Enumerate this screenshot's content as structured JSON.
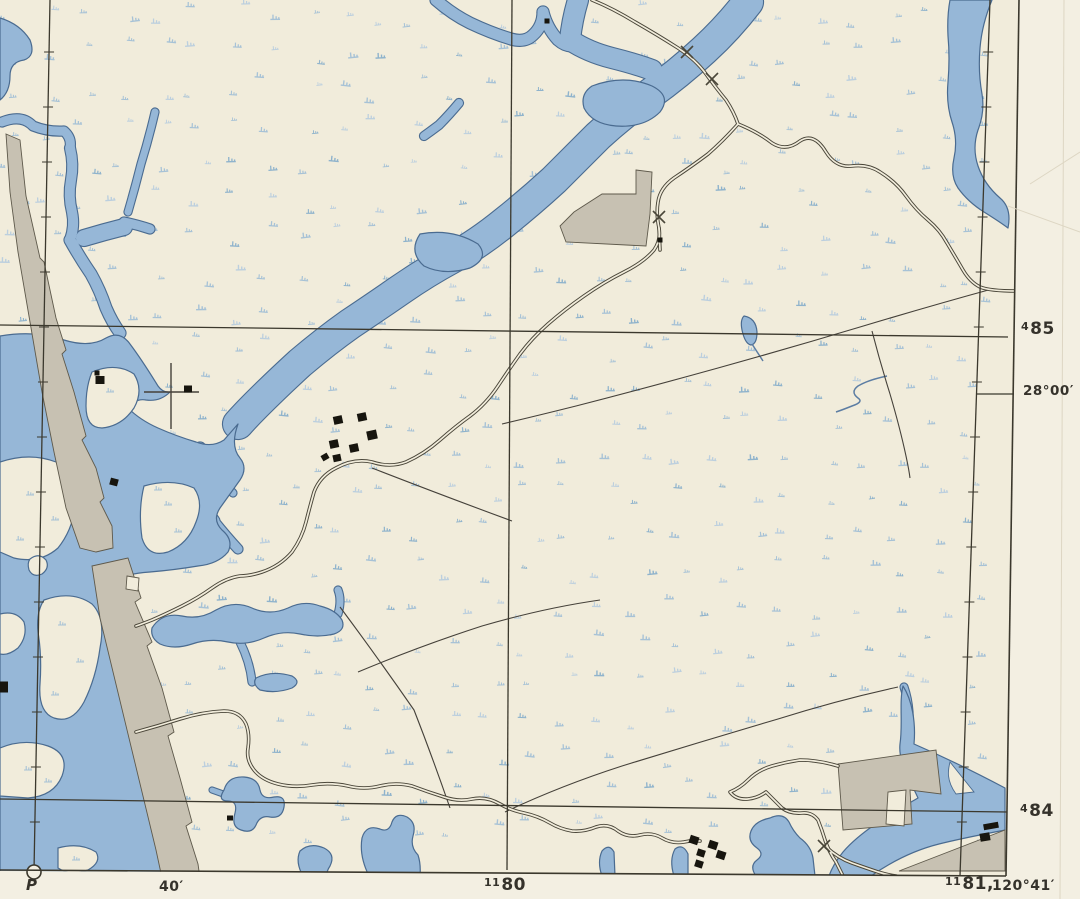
{
  "page": {
    "title": "Scanned topographic map sheet, coastal marsh with tidal creeks"
  },
  "colors": {
    "paper": "#f1ecdb",
    "margin": "#f3efe2",
    "water": "#96b7d7",
    "water_line": "#4a6b90",
    "stream": "#5c7da3",
    "tuft": "#a7c2d6",
    "tuft_light": "#bccfde",
    "tuft_dark": "#8fb3cc",
    "gray_fill": "#c7c1b2",
    "gray_line": "#5e594b",
    "road": "#4a4639",
    "thin": "#45413a",
    "grid": "#3b382d",
    "building": "#17150e",
    "crease": "#ddd6c3",
    "text": "#35322b"
  },
  "margin_labels": {
    "grid_485": {
      "sup": "4",
      "main": "85"
    },
    "lat_2800": "28°00′",
    "grid_484": {
      "sup": "4",
      "main": "84"
    },
    "p_mark": "P",
    "min_40": "40′",
    "grid_1180": {
      "sup": "11",
      "main": "80"
    },
    "grid_1181": {
      "sup": "11",
      "main": "81,"
    },
    "lon_12041": "120°41′"
  },
  "map": {
    "tufts": {
      "seed": 1973,
      "step": 37,
      "jitter": 13
    },
    "water": {
      "creeks": [
        {
          "d": "M 2 122 Q 22 114 33 126 Q 48 132 64 131 Q 72 138 70 148",
          "w": 9
        },
        {
          "d": "M 70 148 Q 74 164 71 180 Q 68 196 72 212 Q 75 226 70 240",
          "w": 10
        },
        {
          "d": "M 70 240 Q 80 258 91 274 Q 100 290 106 308 Q 112 322 120 333",
          "w": 11
        },
        {
          "d": "M 155 112 Q 149 138 141 164 Q 135 188 128 212",
          "w": 7
        },
        {
          "d": "M 124 222 Q 138 225 150 229",
          "w": 9
        },
        {
          "d": "M 84 238 Q 104 232 124 227",
          "w": 16
        },
        {
          "d": "M 459 103 Q 449 115 439 125 Q 431 131 424 136",
          "w": 8
        },
        {
          "d": "M 436 0 Q 452 14 470 23 Q 491 33 511 39 Q 525 43 533 35 Q 543 26 543 12",
          "w": 11
        },
        {
          "d": "M 543 12 Q 547 28 558 40 Q 567 48 576 45",
          "w": 11
        },
        {
          "d": "M 578 0 Q 572 20 570 40 Q 588 52 612 58 Q 636 64 652 70",
          "w": 20
        },
        {
          "d": "M 748 2 Q 728 28 704 50 Q 678 74 650 94 Q 622 114 598 136 Q 576 158 554 180 Q 530 202 505 222 Q 478 244 452 258 Q 426 272 400 290 Q 374 308 350 324 Q 326 341 300 363 Q 276 385 256 405 Q 246 415 238 424",
          "w": 30
        },
        {
          "d": "M 200 448 Q 208 468 205 490 Q 203 508 214 521",
          "w": 11
        },
        {
          "d": "M 207 472 Q 222 480 233 493",
          "w": 7
        },
        {
          "d": "M 214 521 Q 226 536 238 549",
          "w": 9
        },
        {
          "d": "M 338 614 Q 342 600 338 590",
          "w": 7
        },
        {
          "d": "M 240 642 Q 250 662 252 682",
          "w": 7
        },
        {
          "d": "M 226 795 L 212 790",
          "w": 5
        },
        {
          "d": "M 904 687 Q 912 710 908 740",
          "w": 7
        }
      ],
      "polys": [
        "M 0 18 Q 20 24 30 40 Q 36 56 24 60 Q 10 62 10 76 Q 10 92 0 100 Z",
        "M 592 86 Q 624 74 652 86 Q 672 96 660 112 Q 644 128 616 126 Q 592 124 584 108 Q 580 94 592 86 Z",
        "M 420 234 Q 452 228 478 244 Q 490 258 470 268 Q 444 276 424 266 Q 408 252 420 234 Z",
        "M 950 0 L 992 0 Q 982 24 980 48 Q 978 72 982 94 Q 985 112 978 130 Q 972 148 978 166 Q 984 184 1000 198 Q 1012 208 1008 228 Q 1000 222 984 212 Q 968 202 958 188 Q 950 176 954 158 Q 958 140 952 122 Q 946 104 948 82 Q 950 58 948 36 Q 947 16 950 0 Z",
        "M 744 316 Q 756 318 757 332 Q 757 344 751 345 Q 745 344 742 330 Q 740 320 744 316 Z",
        "M 0 336 Q 36 330 64 340 Q 90 348 106 338 Q 120 330 130 344 Q 142 360 158 386 Q 163 393 170 392 Q 160 402 146 400 Q 136 398 128 408 Q 140 420 158 428 Q 176 436 196 442 Q 212 448 224 440 L 238 424 Q 230 446 240 458 Q 248 468 240 480 Q 230 494 220 508 Q 212 520 222 530 Q 234 540 228 552 Q 218 564 198 566 Q 174 570 150 572 Q 122 574 104 584 Q 98 600 104 622 Q 110 646 118 670 Q 126 696 134 722 Q 142 750 148 776 Q 154 804 160 832 Q 163 854 164 876 L 0 876 Z",
        "M 152 628 Q 162 612 182 616 Q 200 620 216 610 Q 234 600 252 608 Q 270 616 288 608 Q 304 600 320 606 Q 336 610 342 620 Q 346 630 334 634 Q 318 638 300 634 Q 282 630 264 638 Q 246 646 228 642 Q 210 638 192 644 Q 174 650 160 644 Q 150 638 152 628 Z",
        "M 256 678 Q 272 670 292 676 Q 302 682 292 688 Q 276 694 260 690 Q 252 684 256 678 Z",
        "M 224 790 Q 228 776 244 777 Q 258 778 260 790 Q 262 800 274 797 Q 286 795 284 807 Q 282 819 270 817 Q 260 815 256 825 Q 252 834 241 830 Q 231 827 235 813 Q 238 801 228 801 Q 217 801 224 790 Z",
        "M 300 851 Q 310 842 324 848 Q 336 854 330 866 Q 326 872 327 876 L 303 876 Q 295 862 300 851 Z",
        "M 362 838 Q 366 824 380 829 Q 389 833 392 822 Q 396 812 407 817 Q 417 823 413 836 Q 410 847 418 855 Q 421 864 420 876 L 369 876 Q 359 856 362 838 Z",
        "M 602 851 Q 609 843 614 852 L 615 876 L 602 876 Q 597 862 602 851 Z",
        "M 675 849 Q 683 843 688 854 L 688 876 L 674 876 Q 669 860 675 849 Z",
        "M 770 818 Q 783 812 789 822 Q 793 831 800 838 Q 811 846 813 858 L 815 876 L 756 876 Q 749 866 757 860 Q 765 854 757 848 Q 747 841 751 831 Q 755 821 770 818 Z",
        "M 903 686 C 899 702 903 724 900 744 C 898 762 910 780 918 798 C 890 814 860 832 843 852 C 835 862 831 870 829 876 L 871 876 C 891 862 915 850 939 844 C 963 838 985 834 1005 830 L 1005 788 C 971 770 937 754 914 744 C 916 722 912 700 903 686 Z"
      ],
      "islands": [
        "M 0 462 Q 30 452 56 462 Q 78 472 76 500 Q 74 528 58 548 Q 40 564 14 558 L 0 552 Z",
        "M 30 559 Q 39 552 46 560 Q 50 568 42 574 Q 33 578 29 570 Q 27 563 30 559 Z",
        "M 44 600 Q 72 590 92 604 Q 106 618 100 648 Q 96 678 84 702 Q 72 724 54 718 Q 38 712 40 684 Q 42 656 38 632 Q 36 612 44 600 Z",
        "M 0 748 Q 24 738 48 746 Q 70 754 62 776 Q 54 796 28 798 L 0 796 Z",
        "M 58 848 Q 80 842 96 852 Q 102 862 88 870 Q 70 876 58 868 Z",
        "M 0 614 Q 16 610 24 622 Q 28 636 18 648 Q 8 656 0 654 Z",
        "M 144 486 Q 172 478 194 488 Q 204 502 196 522 Q 188 544 168 552 Q 148 558 142 538 Q 138 510 144 486 Z",
        "M 92 372 Q 116 362 134 374 Q 144 390 134 408 Q 122 426 102 428 Q 86 428 86 406 Q 86 386 92 372 Z"
      ],
      "island_tufts": [
        [
          30,
          495
        ],
        [
          55,
          520
        ],
        [
          20,
          540
        ],
        [
          62,
          625
        ],
        [
          80,
          662
        ],
        [
          55,
          695
        ],
        [
          28,
          770
        ],
        [
          48,
          782
        ],
        [
          76,
          860
        ],
        [
          168,
          505
        ],
        [
          178,
          532
        ],
        [
          110,
          392
        ],
        [
          158,
          490
        ]
      ],
      "streams": [
        "M 752 344 L 763 361",
        "M 887 376 Q 868 380 858 386 Q 850 392 858 398 Q 864 402 852 406 Q 842 410 836 412"
      ]
    },
    "gray_areas": [
      "M 6 134 L 20 140 L 26 196 L 40 258 L 44 262 L 56 318 L 66 350 L 62 354 L 74 392 L 86 436 L 82 440 L 96 468 L 104 498 L 100 502 L 112 526 L 113 548 L 96 552 L 80 548 L 66 508 L 54 452 L 42 392 L 30 322 L 18 252 L 10 192 Z",
      "M 92 566 L 128 558 L 141 598 L 135 602 L 152 642 L 147 646 L 162 688 L 174 732 L 168 736 L 180 778 L 192 822 L 186 826 L 198 864 L 200 878 L 162 878 L 156 850 L 142 792 L 128 734 L 114 676 L 100 618 Z",
      "M 636 170 L 652 172 L 650 214 L 646 246 L 566 242 L 560 226 L 574 212 L 602 194 L 636 194 Z",
      "M 838 764 L 936 750 L 941 794 L 910 790 L 912 824 L 843 830 Z",
      "M 899 871 L 1005 830 L 1005 871 Z"
    ],
    "white_patches": [
      {
        "d": "M 127 576 L 139 578 L 138 591 L 126 589 Z",
        "s": "g"
      },
      {
        "d": "M 888 792 L 906 790 L 904 826 L 886 824 Z",
        "s": "g"
      },
      {
        "d": "M 950 762 L 974 792 L 956 794 C 946 780 948 770 950 762 Z",
        "s": "w"
      }
    ],
    "thin_lines": [
      "M 992 289 Q 930 306 860 327 Q 790 348 718 368 Q 646 388 576 406 Q 536 416 502 424",
      "M 872 331 Q 880 362 890 394 Q 900 428 906 456 Q 909 470 910 478",
      "M 358 672 Q 420 646 482 626 Q 544 608 600 600",
      "M 898 687 Q 838 700 778 719 Q 700 742 622 766 Q 560 786 505 812",
      "M 340 607 Q 378 658 414 710 Q 432 756 450 808",
      "M 372 468 Q 444 496 512 521"
    ],
    "roads": [
      "M 592 0 Q 612 8 635 22 Q 656 34 678 48 Q 696 60 706 74 Q 716 88 726 100 Q 734 112 738 124",
      "M 738 124 Q 758 132 772 143 Q 786 152 800 141 Q 814 132 826 152 Q 836 168 852 166 Q 868 164 880 172 Q 896 182 906 196 Q 916 210 928 220 Q 940 230 947 243 Q 956 258 963 270 Q 970 282 980 287 Q 990 291 1016 291",
      "M 738 124 Q 724 140 708 154 Q 692 166 674 178 Q 660 188 658 202 Q 656 214 659 228 Q 661 240 654 250 Q 644 262 624 272 Q 604 282 584 296 Q 564 310 548 324 Q 532 338 520 354 Q 510 368 498 386 Q 486 404 470 416 Q 456 426 440 440 Q 424 454 406 462 Q 390 468 372 462 Q 354 458 336 468 Q 320 476 314 492 Q 310 506 306 522 Q 302 538 292 552 Q 280 566 262 572 Q 250 576 240 576 Q 226 578 212 588 Q 198 598 182 606 Q 166 614 152 620 Q 142 624 136 626",
      "M 659 228 L 660 250",
      "M 136 732 Q 158 726 180 719 Q 202 712 224 711 Q 240 711 246 724 Q 250 734 248 748 Q 246 760 254 770 Q 262 780 278 784 Q 294 788 312 785 Q 330 782 348 786 Q 364 790 380 786 Q 396 782 412 786 Q 428 792 444 797 Q 458 802 472 799 Q 486 796 500 804 Q 510 810 524 813 Q 538 816 550 823 Q 560 829 572 831 Q 584 832 596 827 Q 608 823 618 831 Q 628 838 640 835 Q 652 832 662 838 Q 672 844 684 842 Q 692 840 700 841",
      "M 838 766 Q 818 760 800 760 Q 786 762 772 766 Q 758 770 748 780 Q 740 788 730 792 Q 736 800 748 799 Q 758 798 766 792 Q 774 800 782 808 Q 790 814 802 813 Q 812 812 818 820 Q 822 830 825 840 Q 829 852 836 862 Q 840 870 843 876",
      "M 826 847 Q 838 858 852 863 Q 866 868 878 872 Q 888 875 896 876"
    ],
    "grid_lines": [
      "M 0 325 L 1008 337",
      "M 0 799 L 1008 812",
      "M 512 0 L 507 870"
    ],
    "meridians": [
      {
        "x_top": 50,
        "y_top": 0,
        "x_bot": 34,
        "y_bot": 871
      },
      {
        "x_top": 990,
        "y_top": 0,
        "x_bot": 960,
        "y_bot": 876
      }
    ],
    "neat_lines": [
      "M 1019 0 L 1006 876",
      "M 0 870 L 1006 876"
    ],
    "lat_tick": "M 976 394 L 1014 394",
    "creases": [
      "M 1008 206 L 1080 232",
      "M 1030 184 L 1080 152",
      "M 1064 0 L 1060 899"
    ],
    "x_marks": [
      [
        687,
        52
      ],
      [
        712,
        79
      ],
      [
        659,
        217
      ],
      [
        824,
        846
      ]
    ],
    "cross_marks": [
      [
        "M 171 363 L 171 429",
        "M 144 392 L 199 392"
      ]
    ],
    "buildings": [
      [
        100,
        380,
        9,
        8,
        0
      ],
      [
        97,
        373,
        5,
        5,
        0
      ],
      [
        188,
        389,
        8,
        7,
        0
      ],
      [
        338,
        420,
        9,
        8,
        -12
      ],
      [
        362,
        417,
        9,
        8,
        -12
      ],
      [
        372,
        435,
        10,
        9,
        -12
      ],
      [
        334,
        444,
        9,
        8,
        -12
      ],
      [
        354,
        448,
        9,
        8,
        -12
      ],
      [
        337,
        458,
        8,
        7,
        -12
      ],
      [
        547,
        21,
        5,
        5,
        0
      ],
      [
        660,
        240,
        5,
        5,
        0
      ],
      [
        114,
        482,
        8,
        7,
        15
      ],
      [
        325,
        457,
        7,
        6,
        -30
      ],
      [
        4,
        687,
        8,
        11,
        0
      ],
      [
        230,
        818,
        6,
        5,
        0
      ],
      [
        694,
        840,
        9,
        8,
        18
      ],
      [
        713,
        845,
        9,
        8,
        18
      ],
      [
        701,
        853,
        8,
        7,
        18
      ],
      [
        721,
        855,
        9,
        8,
        18
      ],
      [
        699,
        864,
        8,
        7,
        18
      ],
      [
        991,
        826,
        15,
        6,
        -10
      ],
      [
        985,
        837,
        10,
        8,
        -10
      ]
    ],
    "p_circle": {
      "x": 34,
      "y": 872,
      "r": 7
    }
  }
}
